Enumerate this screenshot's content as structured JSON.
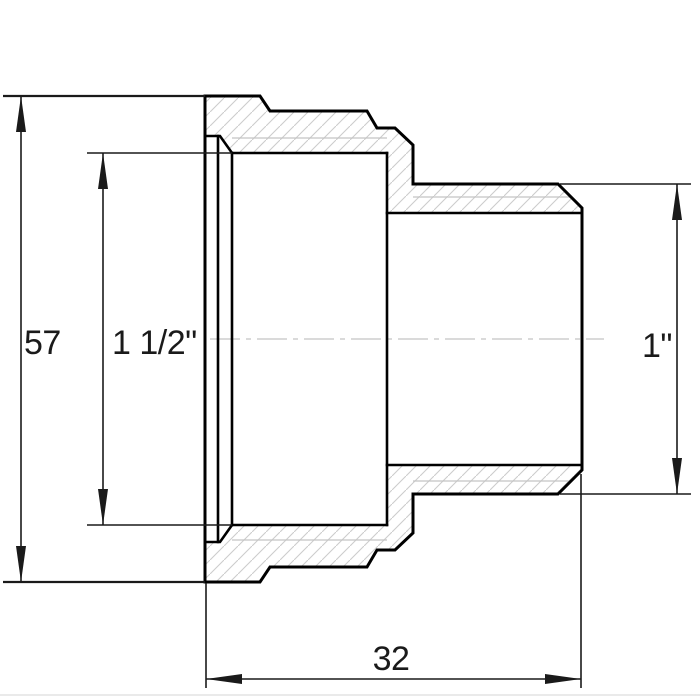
{
  "drawing": {
    "kind": "technical-drawing",
    "dimensions": {
      "outer_height": {
        "label": "57"
      },
      "female_thread": {
        "label": "1 1/2\""
      },
      "male_thread": {
        "label": "1\""
      },
      "length": {
        "label": "32"
      }
    },
    "colors": {
      "background": "#ffffff",
      "outline": "#000000",
      "dimension": "#1a1a1a",
      "thin": "#c4c4c4",
      "hatch": "#cccccc"
    }
  }
}
